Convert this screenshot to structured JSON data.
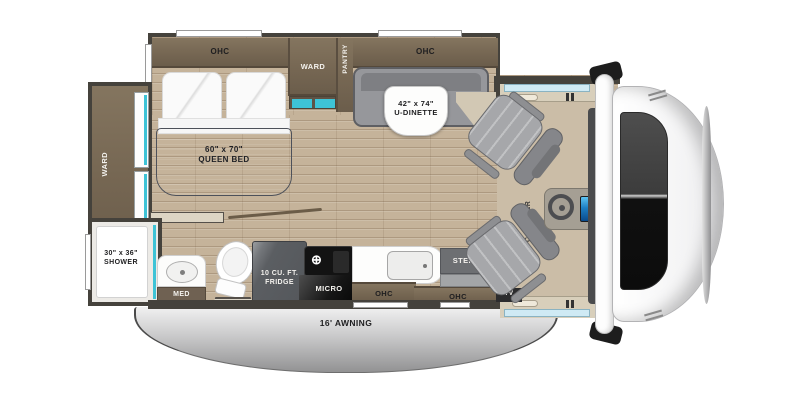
{
  "title": "RV floor plan",
  "colors": {
    "accent_teal": "#3ec3d6",
    "wall": "#45423c",
    "cabinet_wood": "#7a6b58",
    "floor_wood": "#c5b39a",
    "bed_blanket": "#6a6f7a",
    "seat_gray": "#a6a7aa",
    "awning_silver": "#c9c9ca",
    "fridge_gray": "#5b5e62",
    "screen_blue": "#1d7fc4"
  },
  "labels": {
    "ohc": "OHC",
    "ward": "WARD",
    "pantry": "PANTRY",
    "queen_bed_size": "60\" x 70\"",
    "queen_bed_name": "QUEEN BED",
    "dinette_size": "42\" x 74\"",
    "dinette_name": "U-DINETTE",
    "shower_size": "30\" x 36\"",
    "shower_name": "SHOWER",
    "med": "MED",
    "fridge_line1": "10 CU. FT.",
    "fridge_line2": "FRIDGE",
    "micro": "MICRO",
    "steps": "STEPS",
    "tv": "TV",
    "cabover_line1": "CAB-OVER",
    "cabover_line2": "BUNK",
    "awning": "16' AWNING",
    "stove_burner_icon": "⊕"
  }
}
